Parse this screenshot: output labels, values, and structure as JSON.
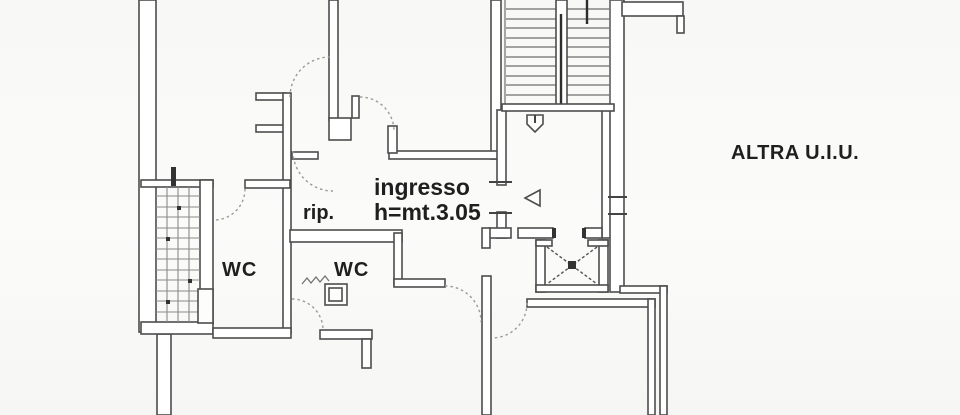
{
  "drawing": {
    "type": "floor-plan-scan",
    "labels": {
      "entrance": "ingresso",
      "entrance_height": "h=mt.3.05",
      "wc_left": "WC",
      "wc_right": "WC",
      "closet": "rip.",
      "other_unit": "ALTRA U.I.U."
    },
    "colors": {
      "background": "#fafaf9",
      "wall_ink": "#4d4d4d",
      "text_ink": "#1f1f1f"
    }
  }
}
